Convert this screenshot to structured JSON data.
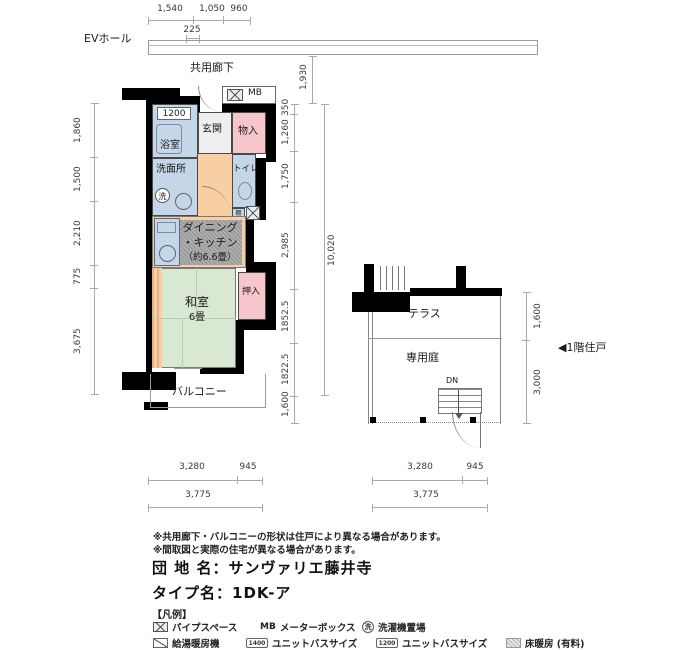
{
  "header": {
    "top_dims": [
      "1,540",
      "1,050",
      "960"
    ],
    "top_sub_dim": "225",
    "ev_hall": "EVホール",
    "corridor": "共用廊下"
  },
  "plan": {
    "mb": "MB",
    "bath_size": "1200",
    "bath": "浴室",
    "entrance": "玄関",
    "storage": "物入",
    "washroom": "洗面所",
    "washer": "洗",
    "toilet": "トイレ",
    "shelf": "棚",
    "dk1": "ダイニング",
    "dk2": "・キッチン",
    "dk3": "（約6.6畳）",
    "washitsu": "和室",
    "washitsu_size": "6畳",
    "closet": "押入",
    "balcony": "バルコニー"
  },
  "site": {
    "terrace": "テラス",
    "garden": "専用庭",
    "down": "DN",
    "unit_pointer": "◀1階住戸"
  },
  "dims": {
    "left": [
      "1,860",
      "1,500",
      "2,210",
      "775",
      "3,675"
    ],
    "right_top": "1,930",
    "right_inner": [
      "350",
      "1,260",
      "1,750",
      "2,985",
      "1852.5",
      "1822.5"
    ],
    "right_balcony": "1,600",
    "right_total": "10,020",
    "terrace_depth": "1,600",
    "garden_depth": "3,000",
    "bottom_left": [
      "3,280",
      "945"
    ],
    "bottom_left_total": "3,775",
    "bottom_right": [
      "3,280",
      "945"
    ],
    "bottom_right_total": "3,775"
  },
  "notes": [
    "※共用廊下・バルコニーの形状は住戸により異なる場合があります。",
    "※間取図と実際の住宅が異なる場合があります。"
  ],
  "info": {
    "estate": "団 地 名：サンヴァリエ藤井寺",
    "type": "タイプ名：1DK-ア"
  },
  "legend": {
    "heading": "【凡例】",
    "pipe_space": "パイプスペース",
    "mb": "MB",
    "mb_desc": "メーターボックス",
    "washer": "洗",
    "washer_desc": "洗濯機置場",
    "heater": "給湯暖房機",
    "bath_a": "1400",
    "bath_a_desc": "ユニットバスサイズ",
    "bath_b": "1200",
    "bath_b_desc": "ユニットバスサイズ",
    "floor_heat": "床暖房 (有料)"
  },
  "colors": {
    "wall": "#000000",
    "wet_blue": "#c6d6e9",
    "closet_pink": "#f6c6ca",
    "floor_orange": "#f8cfa3",
    "tatami_green": "#d9e8d2",
    "heating_gray": "#9c9c9c"
  }
}
